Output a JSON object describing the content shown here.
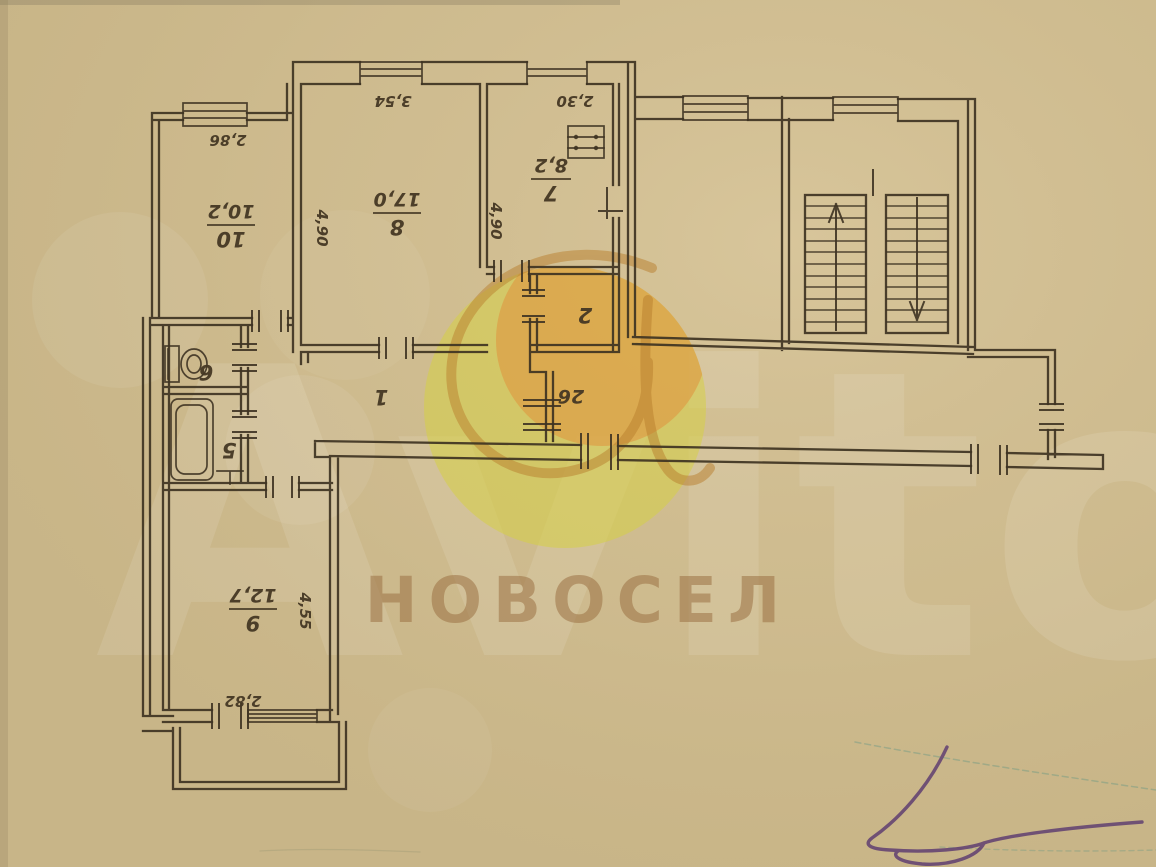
{
  "plan": {
    "rooms": {
      "r10": {
        "number": "10",
        "area": "10,2"
      },
      "r8": {
        "number": "8",
        "area": "17,0"
      },
      "r7": {
        "number": "7",
        "area": "8,2"
      },
      "r9": {
        "number": "9",
        "area": "12,7"
      },
      "r2": {
        "number": "2"
      },
      "r1": {
        "number": "1"
      },
      "r5": {
        "number": "5"
      },
      "r6": {
        "number": "6"
      },
      "vest": {
        "number": "26"
      }
    },
    "dims": {
      "room10_width": "2,86",
      "room8_width": "3,54",
      "room7_width": "2,30",
      "room8_depth_left": "4,90",
      "room8_depth_right": "4,90",
      "room9_depth": "4,55",
      "room9_width": "2,82"
    }
  },
  "watermark": {
    "brand_word": "Avito",
    "agency": "НОВОСЕЛ"
  },
  "colors": {
    "paper": "#cbb88b",
    "ink": "#3e3322",
    "avito_yellow": "#d6d045",
    "avito_orange": "#e0913c",
    "agency_text": "#9c7244",
    "pen": "#5c3a70"
  }
}
